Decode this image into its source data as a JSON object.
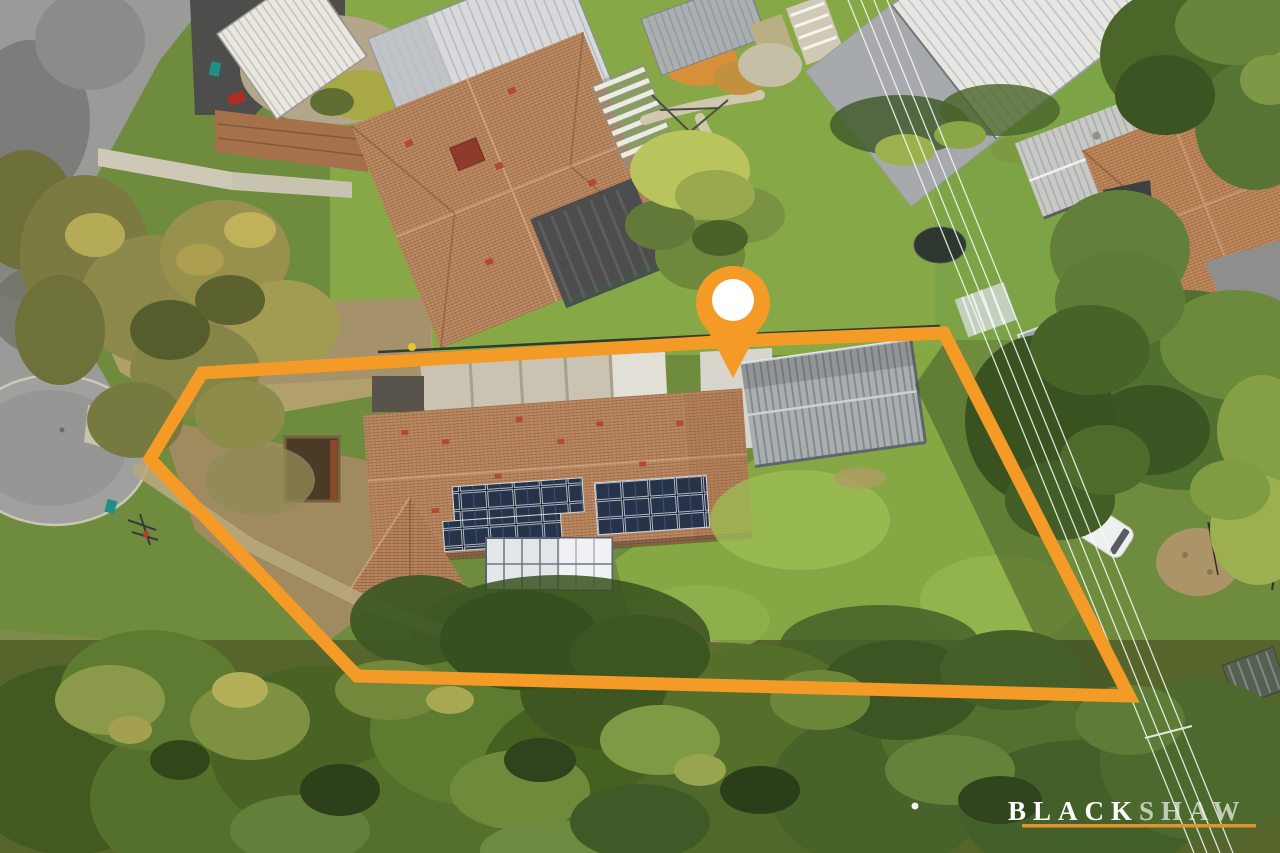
{
  "image": {
    "type": "aerial-property-photo",
    "width": 1280,
    "height": 853
  },
  "branding": {
    "logo_text_bold": "BLACK",
    "logo_text_light": "SHAW",
    "logo_color": "#FFFFFF",
    "logo_secondary_opacity": 0.66,
    "underline_color": "#E2932E"
  },
  "overlay": {
    "accent_color": "#F49B27",
    "boundary_points": "202,373 733,341 944,333 1129,696 357,676 150,459",
    "boundary_stroke_width": 13,
    "pin": {
      "transform": "translate(733,303)",
      "color": "#F49B27",
      "inner_color": "#FFFFFF",
      "inner_radius": 21
    }
  },
  "palette": {
    "road_grey": "#9A9A98",
    "asphalt_dark": "#4D4D4B",
    "concrete_pale": "#CBC3B2",
    "footpath": "#C8C2B0",
    "lawn_green": "#85A844",
    "lawn_light": "#9CBB54",
    "grass_dry_tan": "#B1A06C",
    "dirt_brown": "#A08A5F",
    "canopy_dark": "#42591F",
    "canopy_mid": "#55702A",
    "canopy_olive": "#8C894A",
    "canopy_yellow": "#B2AF57",
    "roof_terracotta": "#BB8A62",
    "roof_red_patch": "#B04A30",
    "roof_metal_white": "#E6E6E2",
    "roof_silver": "#D7D9DB",
    "shed_grey": "#A9AEB0",
    "long_shed_grey": "#C6C9C5",
    "solar_panel": "#232E40",
    "glass_roof": "#E7EAEC",
    "power_line": "#FAFAF5",
    "fence_dark": "#35392E",
    "walkway": "#C3BDAB"
  }
}
